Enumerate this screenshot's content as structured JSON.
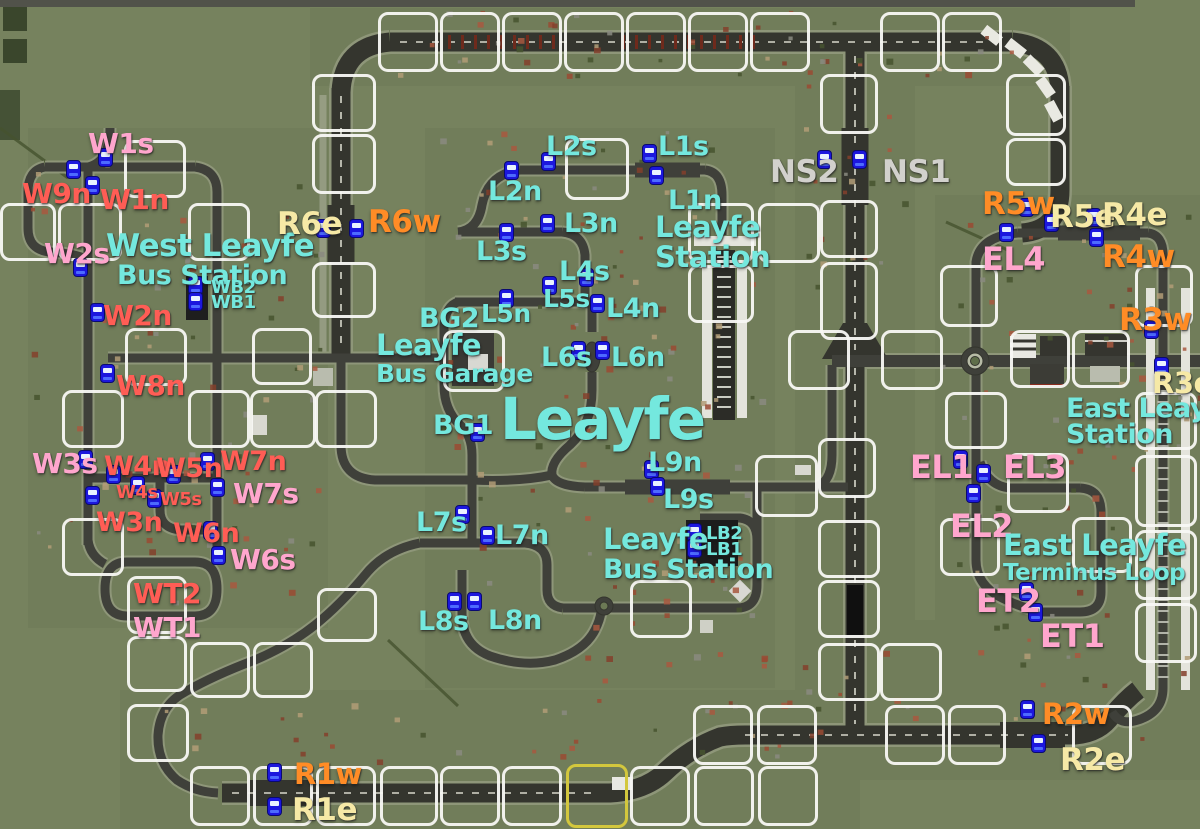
{
  "map_name": "Leayfe",
  "colors": {
    "cyan": "#74e8de",
    "pink": "#ffa6cd",
    "red": "#ff5d55",
    "orange": "#ff8c26",
    "yellow": "#f6e9a6",
    "gray": "#d2d1cd",
    "bus_blue": "#1c17de",
    "tile_border": "#f8f8f4",
    "special_tile_border": "#d3c73d"
  },
  "labels": [
    {
      "id": "w1s",
      "text": "W1s",
      "x": 88,
      "y": 130,
      "size": 28,
      "color": "pink"
    },
    {
      "id": "w9n",
      "text": "W9n",
      "x": 22,
      "y": 180,
      "size": 28,
      "color": "red"
    },
    {
      "id": "w1n",
      "text": "W1n",
      "x": 100,
      "y": 186,
      "size": 28,
      "color": "red"
    },
    {
      "id": "w2s",
      "text": "W2s",
      "x": 44,
      "y": 240,
      "size": 28,
      "color": "pink"
    },
    {
      "id": "west-leayfe-line1",
      "text": "West Leayfe",
      "x": 106,
      "y": 231,
      "size": 31,
      "color": "cyan"
    },
    {
      "id": "west-leayfe-line2",
      "text": "Bus Station",
      "x": 117,
      "y": 262,
      "size": 27,
      "color": "cyan"
    },
    {
      "id": "wb2",
      "text": "WB2",
      "x": 211,
      "y": 279,
      "size": 18,
      "color": "cyan"
    },
    {
      "id": "wb1",
      "text": "WB1",
      "x": 211,
      "y": 294,
      "size": 18,
      "color": "cyan"
    },
    {
      "id": "w2n",
      "text": "W2n",
      "x": 103,
      "y": 302,
      "size": 28,
      "color": "red"
    },
    {
      "id": "w8n",
      "text": "W8n",
      "x": 116,
      "y": 372,
      "size": 28,
      "color": "red"
    },
    {
      "id": "w3s",
      "text": "W3s",
      "x": 32,
      "y": 450,
      "size": 28,
      "color": "pink"
    },
    {
      "id": "w4n",
      "text": "W4n",
      "x": 104,
      "y": 453,
      "size": 27,
      "color": "red"
    },
    {
      "id": "w5n",
      "text": "W5n",
      "x": 156,
      "y": 455,
      "size": 27,
      "color": "red"
    },
    {
      "id": "w7n",
      "text": "W7n",
      "x": 220,
      "y": 448,
      "size": 27,
      "color": "red"
    },
    {
      "id": "w4s",
      "text": "W4s",
      "x": 116,
      "y": 484,
      "size": 18,
      "color": "red"
    },
    {
      "id": "w5s",
      "text": "W5s",
      "x": 160,
      "y": 491,
      "size": 18,
      "color": "red"
    },
    {
      "id": "w7s",
      "text": "W7s",
      "x": 233,
      "y": 480,
      "size": 28,
      "color": "pink"
    },
    {
      "id": "w3n",
      "text": "W3n",
      "x": 96,
      "y": 509,
      "size": 27,
      "color": "red"
    },
    {
      "id": "w6n",
      "text": "W6n",
      "x": 173,
      "y": 520,
      "size": 27,
      "color": "red"
    },
    {
      "id": "w6s",
      "text": "W6s",
      "x": 230,
      "y": 546,
      "size": 28,
      "color": "pink"
    },
    {
      "id": "wt2",
      "text": "WT2",
      "x": 133,
      "y": 580,
      "size": 28,
      "color": "red"
    },
    {
      "id": "wt1",
      "text": "WT1",
      "x": 133,
      "y": 614,
      "size": 28,
      "color": "pink"
    },
    {
      "id": "r6e",
      "text": "R6e",
      "x": 277,
      "y": 209,
      "size": 31,
      "color": "yellow"
    },
    {
      "id": "r6w",
      "text": "R6w",
      "x": 368,
      "y": 207,
      "size": 31,
      "color": "orange"
    },
    {
      "id": "l2s",
      "text": "L2s",
      "x": 546,
      "y": 133,
      "size": 27,
      "color": "cyan"
    },
    {
      "id": "l1s",
      "text": "L1s",
      "x": 658,
      "y": 133,
      "size": 27,
      "color": "cyan"
    },
    {
      "id": "l2n",
      "text": "L2n",
      "x": 488,
      "y": 178,
      "size": 27,
      "color": "cyan"
    },
    {
      "id": "l1n",
      "text": "L1n",
      "x": 668,
      "y": 187,
      "size": 27,
      "color": "cyan"
    },
    {
      "id": "leayfe-station-line1",
      "text": "Leayfe",
      "x": 655,
      "y": 213,
      "size": 29,
      "color": "cyan"
    },
    {
      "id": "leayfe-station-line2",
      "text": "Station",
      "x": 655,
      "y": 243,
      "size": 29,
      "color": "cyan"
    },
    {
      "id": "l3n",
      "text": "L3n",
      "x": 564,
      "y": 210,
      "size": 27,
      "color": "cyan"
    },
    {
      "id": "l3s",
      "text": "L3s",
      "x": 476,
      "y": 238,
      "size": 27,
      "color": "cyan"
    },
    {
      "id": "l4s",
      "text": "L4s",
      "x": 559,
      "y": 258,
      "size": 27,
      "color": "cyan"
    },
    {
      "id": "l5s",
      "text": "L5s",
      "x": 543,
      "y": 286,
      "size": 25,
      "color": "cyan"
    },
    {
      "id": "l5n",
      "text": "L5n",
      "x": 481,
      "y": 301,
      "size": 25,
      "color": "cyan"
    },
    {
      "id": "l4n",
      "text": "L4n",
      "x": 606,
      "y": 295,
      "size": 27,
      "color": "cyan"
    },
    {
      "id": "bg2",
      "text": "BG2",
      "x": 419,
      "y": 305,
      "size": 27,
      "color": "cyan"
    },
    {
      "id": "bus-garage-line1",
      "text": "Leayfe",
      "x": 376,
      "y": 331,
      "size": 29,
      "color": "cyan"
    },
    {
      "id": "bus-garage-line2",
      "text": "Bus Garage",
      "x": 376,
      "y": 361,
      "size": 25,
      "color": "cyan"
    },
    {
      "id": "l6s",
      "text": "L6s",
      "x": 541,
      "y": 344,
      "size": 27,
      "color": "cyan"
    },
    {
      "id": "l6n",
      "text": "L6n",
      "x": 611,
      "y": 344,
      "size": 27,
      "color": "cyan"
    },
    {
      "id": "ns2",
      "text": "NS2",
      "x": 770,
      "y": 157,
      "size": 31,
      "color": "gray"
    },
    {
      "id": "ns1",
      "text": "NS1",
      "x": 882,
      "y": 157,
      "size": 31,
      "color": "gray"
    },
    {
      "id": "r5w",
      "text": "R5w",
      "x": 982,
      "y": 189,
      "size": 31,
      "color": "orange"
    },
    {
      "id": "r5e",
      "text": "R5e",
      "x": 1050,
      "y": 202,
      "size": 31,
      "color": "yellow"
    },
    {
      "id": "r4e",
      "text": "R4e",
      "x": 1102,
      "y": 200,
      "size": 31,
      "color": "yellow"
    },
    {
      "id": "el4",
      "text": "EL4",
      "x": 982,
      "y": 243,
      "size": 32,
      "color": "pink"
    },
    {
      "id": "r4w",
      "text": "R4w",
      "x": 1102,
      "y": 242,
      "size": 31,
      "color": "orange"
    },
    {
      "id": "r3w",
      "text": "R3w",
      "x": 1119,
      "y": 305,
      "size": 31,
      "color": "orange"
    },
    {
      "id": "r3e",
      "text": "R3e",
      "x": 1152,
      "y": 369,
      "size": 29,
      "color": "yellow"
    },
    {
      "id": "east-leayfe-station-line1",
      "text": "East Leayfe",
      "x": 1066,
      "y": 395,
      "size": 27,
      "color": "cyan"
    },
    {
      "id": "east-leayfe-station-line2",
      "text": "Station",
      "x": 1066,
      "y": 421,
      "size": 27,
      "color": "cyan"
    },
    {
      "id": "bg1",
      "text": "BG1",
      "x": 433,
      "y": 412,
      "size": 27,
      "color": "cyan"
    },
    {
      "id": "leayfe-town",
      "text": "Leayfe",
      "x": 500,
      "y": 390,
      "size": 58,
      "color": "cyan"
    },
    {
      "id": "l9n",
      "text": "L9n",
      "x": 648,
      "y": 449,
      "size": 27,
      "color": "cyan"
    },
    {
      "id": "l9s",
      "text": "L9s",
      "x": 663,
      "y": 486,
      "size": 27,
      "color": "cyan"
    },
    {
      "id": "el1",
      "text": "EL1",
      "x": 910,
      "y": 451,
      "size": 32,
      "color": "pink"
    },
    {
      "id": "el3",
      "text": "EL3",
      "x": 1003,
      "y": 451,
      "size": 32,
      "color": "pink"
    },
    {
      "id": "el2",
      "text": "EL2",
      "x": 950,
      "y": 510,
      "size": 32,
      "color": "pink"
    },
    {
      "id": "east-leayfe-terminus-line1",
      "text": "East Leayfe",
      "x": 1003,
      "y": 531,
      "size": 29,
      "color": "cyan"
    },
    {
      "id": "east-leayfe-terminus-line2",
      "text": "Terminus Loop",
      "x": 1003,
      "y": 562,
      "size": 23,
      "color": "cyan"
    },
    {
      "id": "l7s",
      "text": "L7s",
      "x": 416,
      "y": 509,
      "size": 27,
      "color": "cyan"
    },
    {
      "id": "l7n",
      "text": "L7n",
      "x": 495,
      "y": 522,
      "size": 27,
      "color": "cyan"
    },
    {
      "id": "leayfe-bus-station-line1",
      "text": "Leayfe",
      "x": 603,
      "y": 525,
      "size": 29,
      "color": "cyan"
    },
    {
      "id": "leayfe-bus-station-line2",
      "text": "Bus Station",
      "x": 603,
      "y": 556,
      "size": 27,
      "color": "cyan"
    },
    {
      "id": "lb2",
      "text": "LB2",
      "x": 706,
      "y": 525,
      "size": 18,
      "color": "cyan"
    },
    {
      "id": "lb1",
      "text": "LB1",
      "x": 706,
      "y": 541,
      "size": 18,
      "color": "cyan"
    },
    {
      "id": "et2",
      "text": "ET2",
      "x": 976,
      "y": 585,
      "size": 32,
      "color": "pink"
    },
    {
      "id": "et1",
      "text": "ET1",
      "x": 1040,
      "y": 620,
      "size": 32,
      "color": "pink"
    },
    {
      "id": "l8s",
      "text": "L8s",
      "x": 418,
      "y": 608,
      "size": 27,
      "color": "cyan"
    },
    {
      "id": "l8n",
      "text": "L8n",
      "x": 488,
      "y": 607,
      "size": 27,
      "color": "cyan"
    },
    {
      "id": "r2w",
      "text": "R2w",
      "x": 1042,
      "y": 700,
      "size": 29,
      "color": "orange"
    },
    {
      "id": "r2e",
      "text": "R2e",
      "x": 1060,
      "y": 745,
      "size": 31,
      "color": "yellow"
    },
    {
      "id": "r1w",
      "text": "R1w",
      "x": 294,
      "y": 760,
      "size": 29,
      "color": "orange"
    },
    {
      "id": "r1e",
      "text": "R1e",
      "x": 292,
      "y": 795,
      "size": 31,
      "color": "yellow"
    }
  ],
  "bus_stops": [
    [
      98,
      148
    ],
    [
      66,
      160
    ],
    [
      85,
      176
    ],
    [
      73,
      258
    ],
    [
      188,
      276
    ],
    [
      188,
      292
    ],
    [
      90,
      303
    ],
    [
      100,
      364
    ],
    [
      78,
      450
    ],
    [
      106,
      465
    ],
    [
      166,
      465
    ],
    [
      200,
      452
    ],
    [
      130,
      476
    ],
    [
      147,
      489
    ],
    [
      210,
      478
    ],
    [
      85,
      486
    ],
    [
      203,
      521
    ],
    [
      211,
      546
    ],
    [
      316,
      219
    ],
    [
      349,
      219
    ],
    [
      541,
      152
    ],
    [
      504,
      161
    ],
    [
      642,
      144
    ],
    [
      649,
      166
    ],
    [
      540,
      214
    ],
    [
      499,
      223
    ],
    [
      579,
      268
    ],
    [
      542,
      276
    ],
    [
      499,
      289
    ],
    [
      590,
      294
    ],
    [
      571,
      341
    ],
    [
      595,
      341
    ],
    [
      470,
      423
    ],
    [
      644,
      460
    ],
    [
      650,
      477
    ],
    [
      455,
      505
    ],
    [
      480,
      526
    ],
    [
      687,
      523
    ],
    [
      687,
      539
    ],
    [
      447,
      592
    ],
    [
      467,
      592
    ],
    [
      817,
      150
    ],
    [
      852,
      150
    ],
    [
      1019,
      198
    ],
    [
      1044,
      213
    ],
    [
      1086,
      208
    ],
    [
      999,
      223
    ],
    [
      1089,
      228
    ],
    [
      1144,
      320
    ],
    [
      1154,
      357
    ],
    [
      953,
      450
    ],
    [
      976,
      464
    ],
    [
      966,
      484
    ],
    [
      1019,
      582
    ],
    [
      1028,
      603
    ],
    [
      1020,
      700
    ],
    [
      1031,
      734
    ],
    [
      267,
      763
    ],
    [
      267,
      797
    ]
  ]
}
